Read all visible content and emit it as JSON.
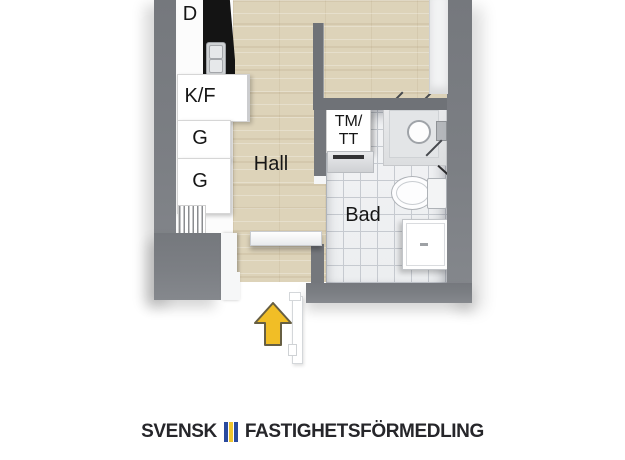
{
  "plan": {
    "kitchen": {
      "dishwasher_label": "D",
      "fridge_freezer_label": "K/F",
      "wardrobe_label_1": "G",
      "wardrobe_label_2": "G"
    },
    "hall": {
      "label": "Hall"
    },
    "bathroom": {
      "label": "Bad",
      "washer_dryer_label_line1": "TM/",
      "washer_dryer_label_line2": "TT"
    }
  },
  "branding": {
    "name_part1": "SVENSK",
    "name_part2": "FASTIGHETSFÖRMEDLING"
  },
  "colors": {
    "wall_gray": "#7a7d82",
    "wood_floor": "#ddd3b9",
    "bath_tile": "#f0f1f3",
    "tile_grout": "#c6cad0",
    "counter_black": "#141414",
    "arrow_yellow": "#f1be26",
    "arrow_outline": "#675f43",
    "flag_blue": "#2a4a9d",
    "flag_yellow": "#eec42d",
    "logo_text": "#26262a"
  }
}
